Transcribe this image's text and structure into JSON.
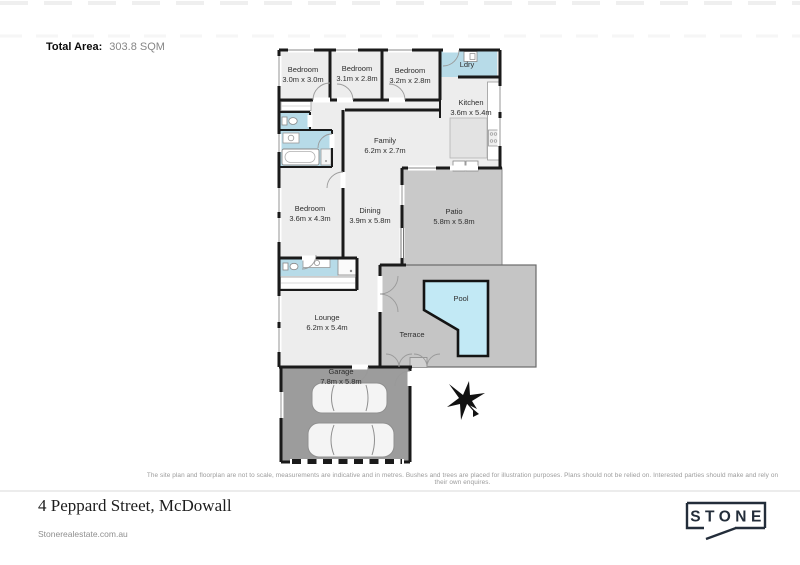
{
  "header": {
    "total_area_label": "Total Area:",
    "total_area_value": "303.8 SQM"
  },
  "rooms": {
    "bedroom1": {
      "name": "Bedroom",
      "dims": "3.0m x 3.0m"
    },
    "bedroom2": {
      "name": "Bedroom",
      "dims": "3.1m x 2.8m"
    },
    "bedroom3": {
      "name": "Bedroom",
      "dims": "3.2m x 2.8m"
    },
    "laundry": {
      "name": "Ldry",
      "dims": ""
    },
    "kitchen": {
      "name": "Kitchen",
      "dims": "3.6m x 5.4m"
    },
    "family": {
      "name": "Family",
      "dims": "6.2m x 2.7m"
    },
    "bedroom4": {
      "name": "Bedroom",
      "dims": "3.6m x 4.3m"
    },
    "dining": {
      "name": "Dining",
      "dims": "3.9m x 5.8m"
    },
    "patio": {
      "name": "Patio",
      "dims": "5.8m x 5.8m"
    },
    "pool": {
      "name": "Pool",
      "dims": ""
    },
    "terrace": {
      "name": "Terrace",
      "dims": ""
    },
    "lounge": {
      "name": "Lounge",
      "dims": "6.2m x 5.4m"
    },
    "garage": {
      "name": "Garage",
      "dims": "7.8m x 5.8m"
    }
  },
  "disclaimer": "The site plan and floorplan are not to scale, measurements are indicative and in metres. Bushes and trees are placed for illustration purposes. Plans should not be relied on. Interested parties should make and rely on their own enquires.",
  "footer": {
    "address": "4 Peppard Street, McDowall",
    "website": "Stonerealestate.com.au",
    "brand": "STONE"
  },
  "colors": {
    "wall": "#1a1a1a",
    "room": "#ededed",
    "wet": "#b7dbe8",
    "pool": "#c2e9f5",
    "patio": "#c9c9c9",
    "terrace": "#c5c5c5",
    "garage": "#9c9c9c",
    "brand": "#232d3a"
  }
}
